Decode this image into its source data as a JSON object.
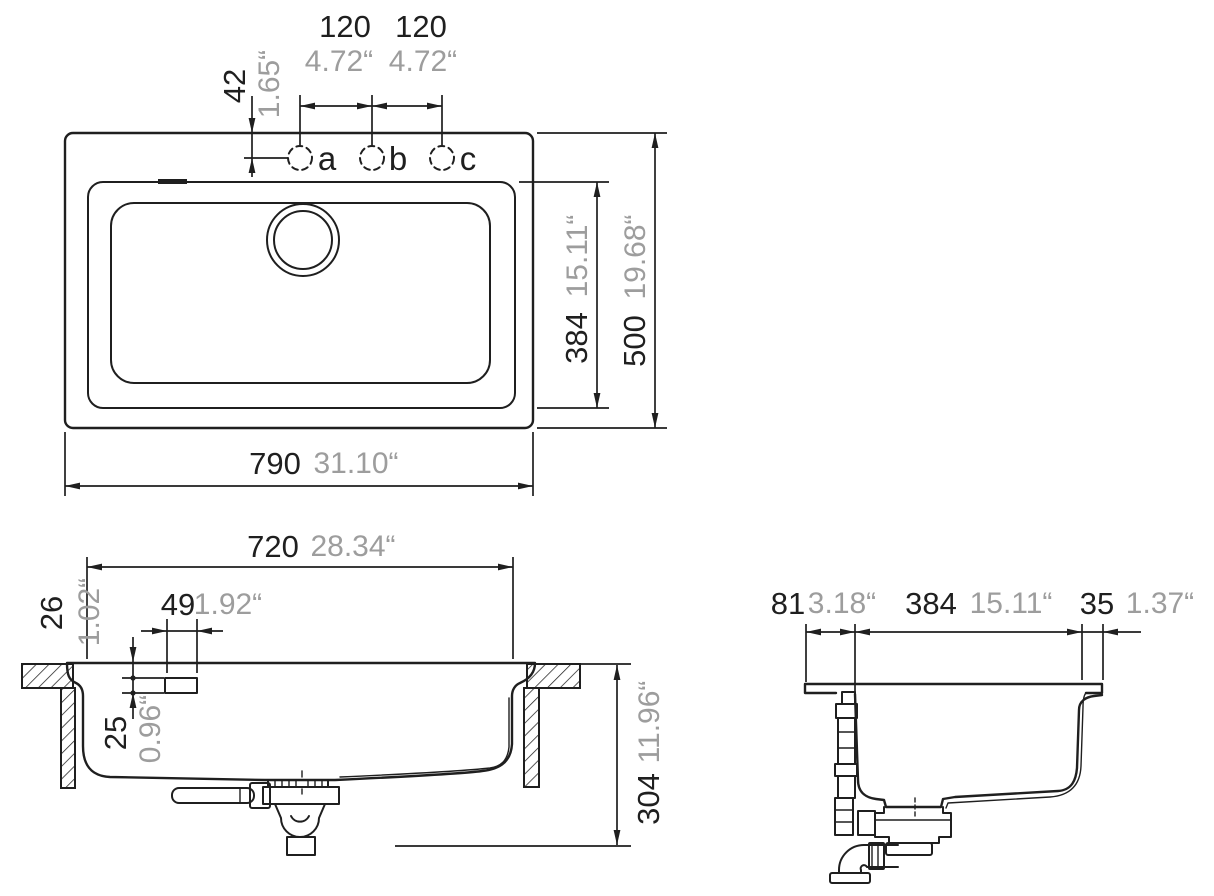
{
  "drawing": {
    "kind": "sink-installation-dimension-drawing",
    "colors": {
      "line": "#1f1f1f",
      "mm_text": "#1f1f1f",
      "inch_text": "#9d9d9d",
      "background": "#ffffff"
    },
    "top_view": {
      "hole_labels": {
        "a": "a",
        "b": "b",
        "c": "c"
      },
      "dims": {
        "hole_spacing_ab": {
          "mm": "120",
          "inch": "4.72“"
        },
        "hole_spacing_bc": {
          "mm": "120",
          "inch": "4.72“"
        },
        "hole_edge_offset": {
          "mm": "42",
          "inch": "1.65“"
        },
        "bowl_depth": {
          "mm": "384",
          "inch": "15.11“"
        },
        "overall_depth": {
          "mm": "500",
          "inch": "19.68“"
        },
        "overall_width": {
          "mm": "790",
          "inch": "31.10“"
        }
      }
    },
    "front_view": {
      "dims": {
        "cutout_width": {
          "mm": "720",
          "inch": "28.34“"
        },
        "rim_to_overflow": {
          "mm": "26",
          "inch": "1.02“"
        },
        "overflow_width": {
          "mm": "49",
          "inch": "1.92“"
        },
        "overflow_height": {
          "mm": "25",
          "inch": "0.96“"
        },
        "installation_depth": {
          "mm": "304",
          "inch": "11.96“"
        }
      }
    },
    "side_view": {
      "dims": {
        "front_offset": {
          "mm": "81",
          "inch": "3.18“"
        },
        "bowl_width": {
          "mm": "384",
          "inch": "15.11“"
        },
        "back_offset": {
          "mm": "35",
          "inch": "1.37“"
        }
      }
    }
  }
}
